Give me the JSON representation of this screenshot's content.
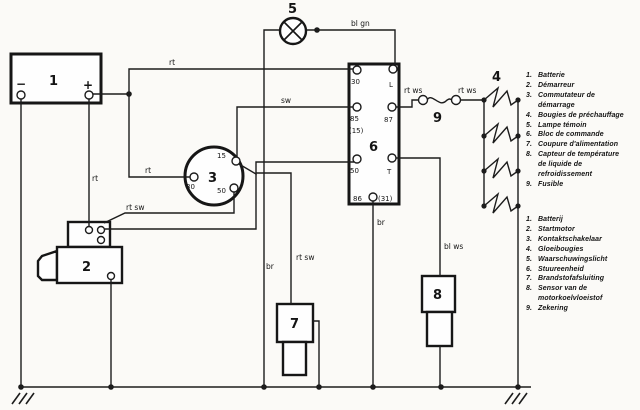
{
  "components": {
    "battery": {
      "id": "1",
      "minus": "−",
      "plus": "+"
    },
    "starter": {
      "id": "2"
    },
    "ignition_switch": {
      "id": "3",
      "t15": "15",
      "t30": "30",
      "t50": "50"
    },
    "glow_plugs": {
      "id": "4"
    },
    "warning_lamp": {
      "id": "5"
    },
    "control_unit": {
      "id": "6",
      "t30": "30",
      "tL": "L",
      "t85": "85",
      "t15_alt": "(15)",
      "t87": "87",
      "t50": "50",
      "tT": "T",
      "t86": "86",
      "t31": "(31)"
    },
    "fuel_cutoff": {
      "id": "7"
    },
    "temp_sensor": {
      "id": "8"
    },
    "fuse": {
      "id": "9"
    }
  },
  "wire_labels": {
    "rt_top": "rt",
    "rt_mid": "rt",
    "rt_batt": "rt",
    "rt_sw_starter": "rt sw",
    "sw": "sw",
    "bl_gn": "bl gn",
    "rt_ws_left": "rt ws",
    "rt_ws_right": "rt ws",
    "br_lamp": "br",
    "rt_sw_cutoff": "rt sw",
    "br_unit": "br",
    "bl_ws": "bl ws"
  },
  "legend_fr": {
    "items": [
      {
        "num": "1.",
        "lines": [
          "Batterie"
        ]
      },
      {
        "num": "2.",
        "lines": [
          "Démarreur"
        ]
      },
      {
        "num": "3.",
        "lines": [
          "Commutateur de",
          "démarrage"
        ]
      },
      {
        "num": "4.",
        "lines": [
          "Bougies de préchauffage"
        ]
      },
      {
        "num": "5.",
        "lines": [
          "Lampe témoin"
        ]
      },
      {
        "num": "6.",
        "lines": [
          "Bloc de commande"
        ]
      },
      {
        "num": "7.",
        "lines": [
          "Coupure d'alimentation"
        ]
      },
      {
        "num": "8.",
        "lines": [
          "Capteur de température",
          "de liquide de",
          "refroidissement"
        ]
      },
      {
        "num": "9.",
        "lines": [
          "Fusible"
        ]
      }
    ]
  },
  "legend_nl": {
    "items": [
      {
        "num": "1.",
        "lines": [
          "Batterij"
        ]
      },
      {
        "num": "2.",
        "lines": [
          "Startmotor"
        ]
      },
      {
        "num": "3.",
        "lines": [
          "Kontaktschakelaar"
        ]
      },
      {
        "num": "4.",
        "lines": [
          "Gloeibougies"
        ]
      },
      {
        "num": "5.",
        "lines": [
          "Waarschuwingslicht"
        ]
      },
      {
        "num": "6.",
        "lines": [
          "Stuureenheid"
        ]
      },
      {
        "num": "7.",
        "lines": [
          "Brandstofafsluiting"
        ]
      },
      {
        "num": "8.",
        "lines": [
          "Sensor van de",
          "motorkoelvloeistof"
        ]
      },
      {
        "num": "9.",
        "lines": [
          "Zekering"
        ]
      }
    ]
  }
}
